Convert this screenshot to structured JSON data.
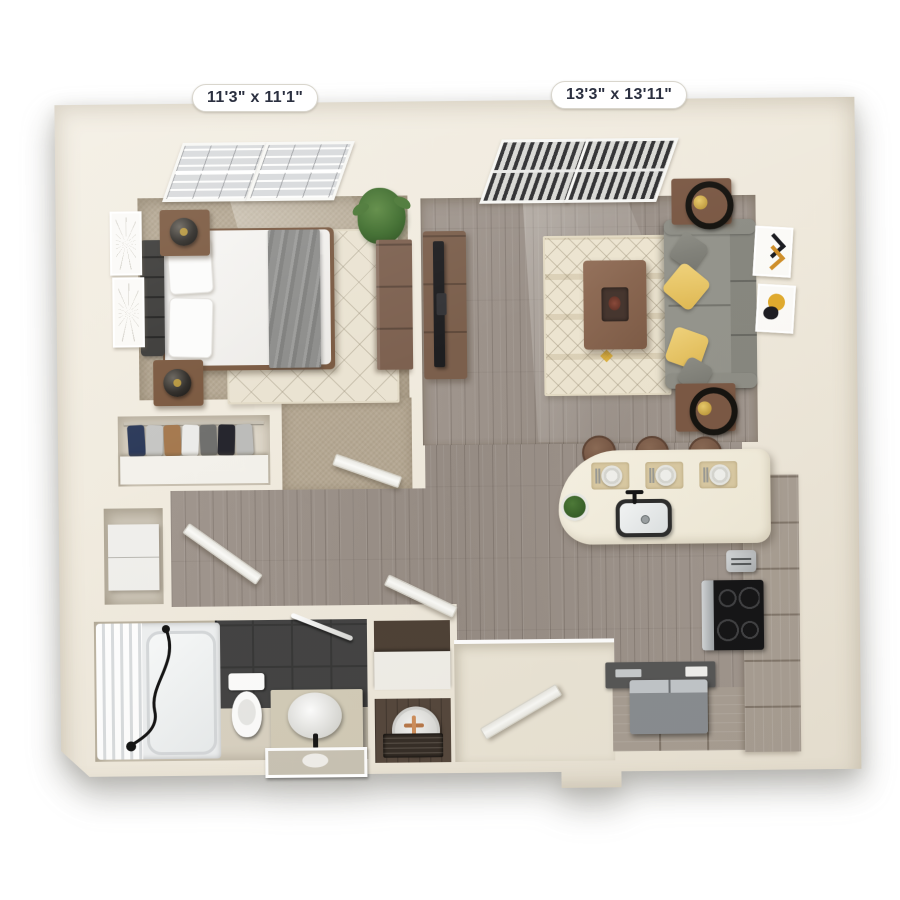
{
  "floorplan": {
    "bedroom": {
      "dimensions": "11'3\" x 11'1\""
    },
    "living_room": {
      "dimensions": "13'3\" x 13'11\""
    }
  },
  "palette": {
    "page_background": "#ffffff",
    "wall_cream": "#f0ebdf",
    "carpet_beige": "#b5a893",
    "wood_floor_gray": "#9c928a",
    "bathroom_tile_dark": "#434343",
    "sofa_gray": "#94948c",
    "pillow_yellow": "#e7c469",
    "wood_furniture_brown": "#7b5a42",
    "kitchen_cabinet_gray": "#a89e93",
    "appliance_black": "#141416",
    "label_text_navy": "#2b3040"
  }
}
